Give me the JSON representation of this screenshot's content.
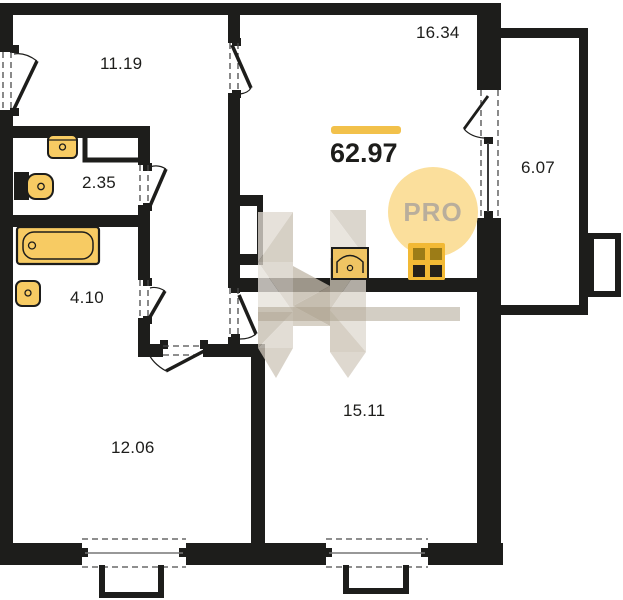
{
  "plan": {
    "title": "apartment floor plan",
    "total_area": "62.97",
    "badge_label": "PRO",
    "rooms": [
      {
        "id": "room-top-left",
        "area": "11.19"
      },
      {
        "id": "kitchen-living",
        "area": "16.34"
      },
      {
        "id": "wc",
        "area": "2.35"
      },
      {
        "id": "bathroom",
        "area": "4.10"
      },
      {
        "id": "balcony",
        "area": "6.07"
      },
      {
        "id": "room-bottom-left",
        "area": "12.06"
      },
      {
        "id": "room-bottom-right",
        "area": "15.11"
      }
    ],
    "icons": [
      "bathtub-icon",
      "sink-icon",
      "toilet-icon",
      "kitchen-sink-icon",
      "stove-icon",
      "watermark-h-logo"
    ],
    "colors": {
      "wall": "#1d1d1b",
      "fixture_yellow": "#F7CB63",
      "stove_frame": "#F2B935",
      "stove_pane_dark": "#26211A",
      "stove_pane_olive": "#9C7C17",
      "accent_bar": "#F2C14B",
      "badge_bg": "#FBDF9C",
      "badge_text": "#B9AE9C",
      "watermark_beige": "#D5CEC4"
    }
  }
}
